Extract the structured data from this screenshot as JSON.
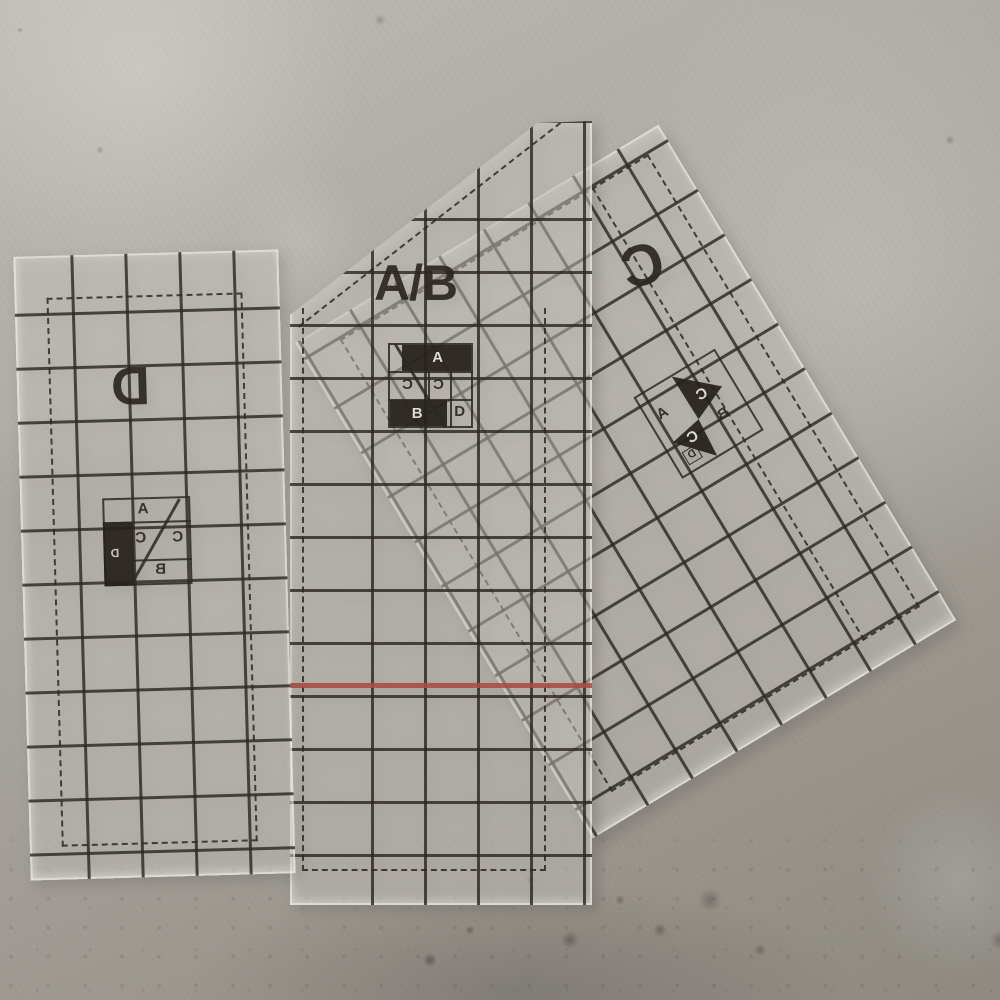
{
  "templates": {
    "left": {
      "label": "D",
      "diagram": {
        "a": "A",
        "c1": "C",
        "c2": "C",
        "b": "B",
        "d": "D"
      }
    },
    "middle": {
      "label": "A/B",
      "diagram": {
        "a": "A",
        "c1": "C",
        "c2": "C",
        "b": "B",
        "d": "D"
      }
    },
    "right": {
      "label": "C",
      "diagram": {
        "a": "A",
        "c1": "C",
        "c2": "C",
        "b": "B",
        "d": "D"
      }
    }
  },
  "colors": {
    "grid_line": "rgba(44,40,34,0.82)",
    "dashed_line": "rgba(44,40,34,0.85)",
    "label_ink": "rgba(43,38,32,0.92)",
    "highlight_fill": "rgba(38,33,28,0.92)",
    "red_guide_line": "#ab4c43"
  }
}
